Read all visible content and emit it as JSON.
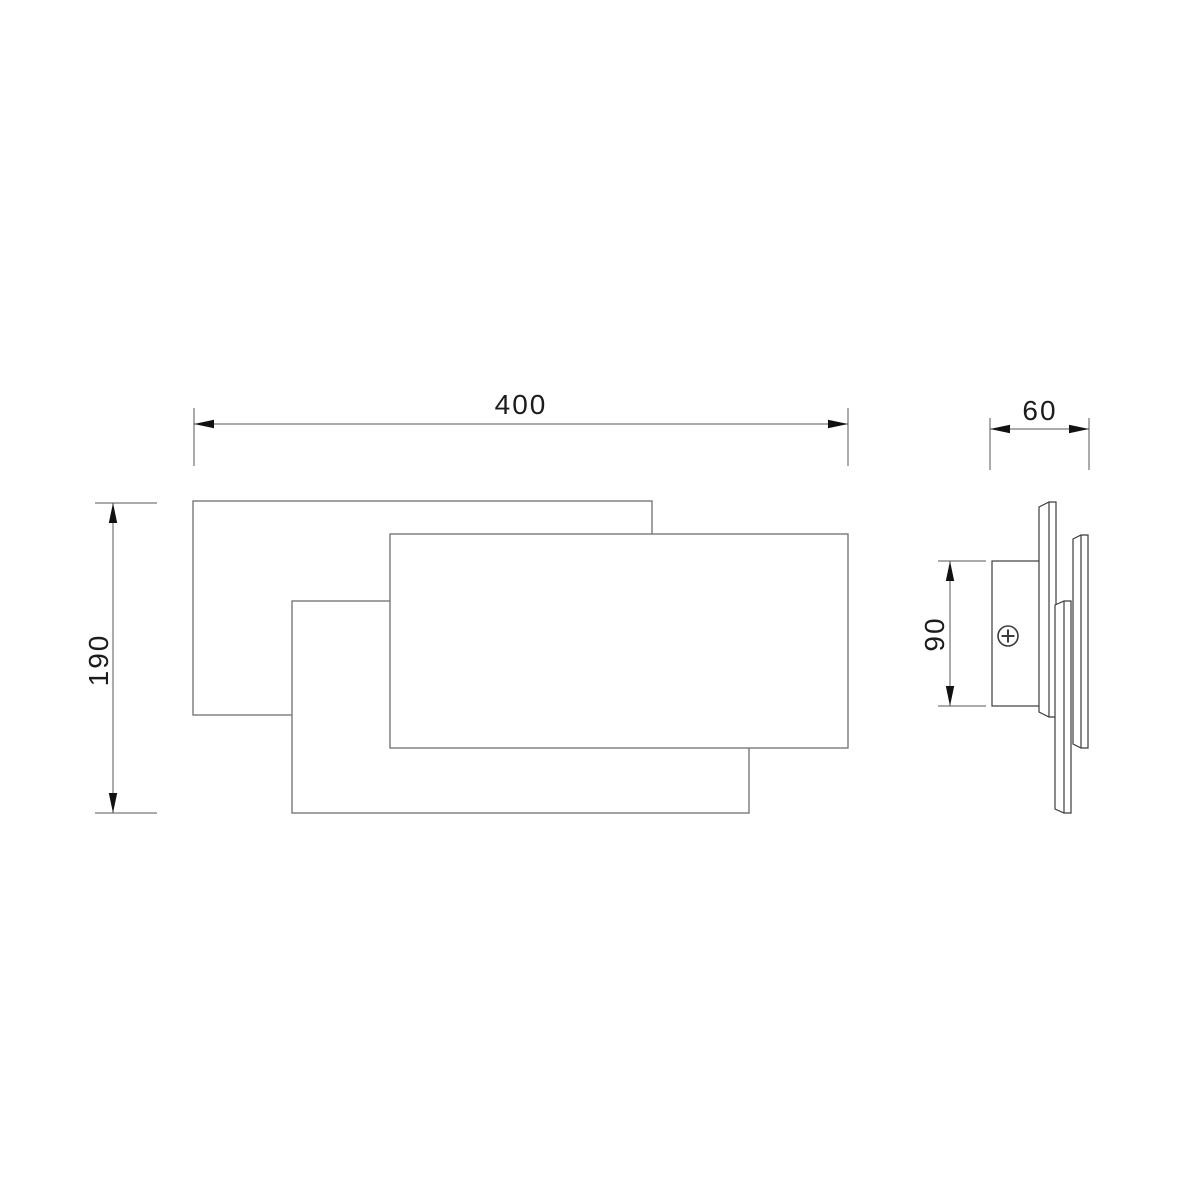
{
  "drawing": {
    "kind": "technical-dimension-drawing",
    "background": "#ffffff",
    "colors": {
      "front_view_outline": "#6e6e6e",
      "side_view_outline": "#3c3c3c",
      "dimension_line": "#575757",
      "arrowhead": "#111111",
      "label_text": "#1c1c1c"
    },
    "views": {
      "front": {
        "parts": [
          "back-panel",
          "middle-panel",
          "front-panel"
        ]
      },
      "side": {
        "parts": [
          "mounting-bracket",
          "phillips-screw",
          "back-plate-edge",
          "middle-plate-edge",
          "front-plate-edge"
        ]
      }
    },
    "dims": {
      "width": "400",
      "height": "190",
      "depth": "60",
      "bracket_height": "90"
    }
  }
}
